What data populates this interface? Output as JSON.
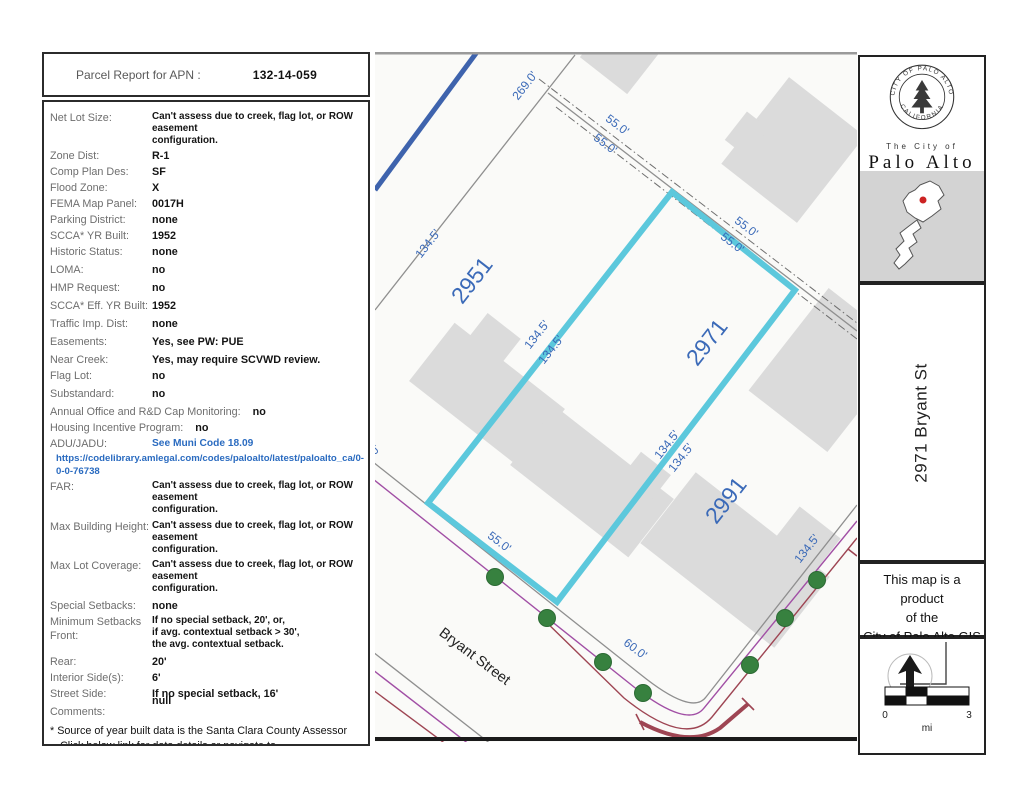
{
  "report": {
    "header_label": "Parcel Report for APN :",
    "apn": "132-14-059",
    "fields": [
      {
        "label": "Net Lot Size:",
        "value": "Can't assess due to creek, flag lot, or ROW easement\nconfiguration.",
        "cls": "ml"
      },
      {
        "label": "Zone Dist:",
        "value": "R-1"
      },
      {
        "label": "Comp Plan Des:",
        "value": "SF"
      },
      {
        "label": "Flood Zone:",
        "value": "X"
      },
      {
        "label": "FEMA Map Panel:",
        "value": "0017H"
      },
      {
        "label": "Parking District:",
        "value": "none"
      },
      {
        "label": "SCCA* YR Built:",
        "value": "1952"
      },
      {
        "label": "Historic Status:",
        "value": "none"
      },
      {
        "label": "LOMA:",
        "value": "no",
        "cls": "gap"
      },
      {
        "label": "HMP Request:",
        "value": "no",
        "cls": "gap"
      },
      {
        "label": "SCCA* Eff. YR Built:",
        "value": "1952",
        "cls": "gap"
      },
      {
        "label": "Traffic Imp. Dist:",
        "value": "none",
        "cls": "gap"
      },
      {
        "label": "Easements:",
        "value": "Yes, see PW: PUE",
        "cls": "gap"
      },
      {
        "label": "Near Creek:",
        "value": "Yes, may require SCVWD review.",
        "cls": "gap"
      },
      {
        "label": "Flag Lot:",
        "value": "no"
      },
      {
        "label": "Substandard:",
        "value": "no",
        "cls": "gap"
      },
      {
        "label": "Annual Office and R&D Cap Monitoring:",
        "value": "no",
        "cls": "wide gap"
      },
      {
        "label": "Housing Incentive Program:",
        "value": "no",
        "cls": "wide"
      },
      {
        "label": "ADU/JADU:",
        "value": "See Muni Code 18.09",
        "cls": "linkval",
        "link": true
      },
      {
        "label": "",
        "value": "https://codelibrary.amlegal.com/codes/paloalto/latest/paloalto_ca/0-0-0-76738",
        "cls": "linkrow",
        "link": true
      },
      {
        "label": "FAR:",
        "value": "Can't assess due to creek, flag lot, or ROW easement\nconfiguration.",
        "cls": "ml"
      },
      {
        "label": "Max Building Height:",
        "value": "Can't assess due to creek, flag lot, or ROW easement\nconfiguration.",
        "cls": "ml gap"
      },
      {
        "label": "Max Lot Coverage:",
        "value": "Can't assess due to creek, flag lot, or ROW easement\nconfiguration.",
        "cls": "ml gap"
      },
      {
        "label": "Special Setbacks:",
        "value": "none",
        "cls": "gap"
      },
      {
        "label": "Minimum Setbacks\nFront:",
        "value": "If no special setback, 20', or,\nif avg. contextual setback > 30',\nthe avg. contextual setback.",
        "cls": "ml"
      },
      {
        "label": "Rear:",
        "value": "20'",
        "cls": "gap"
      },
      {
        "label": "Interior Side(s):",
        "value": "6'"
      },
      {
        "label": "Street Side:",
        "value": "If no special setback, 16'"
      },
      {
        "label": "Comments:",
        "value": "null",
        "cls": "comments gap"
      }
    ],
    "footnote_line1": "* Source of year built data is the Santa Clara County Assessor",
    "footnote_line2": "Click below link for data details or navigate to",
    "footnote_link": "https://www.cityofpaloalto.org/gov/depts/pln/current/parcel_reports.asp"
  },
  "map": {
    "labels": [
      {
        "text": "269.0'"
      },
      {
        "text": "55.0'"
      },
      {
        "text": "55.0'"
      },
      {
        "text": "134.5'"
      },
      {
        "text": "2951"
      },
      {
        "text": "134.5'"
      },
      {
        "text": "134.5'"
      },
      {
        "text": "2971"
      },
      {
        "text": "55.0'"
      },
      {
        "text": "55.0'"
      },
      {
        "text": "134.5'"
      },
      {
        "text": "134.5'"
      },
      {
        "text": "2991"
      },
      {
        "text": "55.0'"
      },
      {
        "text": "60.0'"
      },
      {
        "text": "134.5'"
      },
      {
        "text": "0'"
      },
      {
        "text": "Bryant Street"
      }
    ],
    "colors": {
      "highlight_cyan": "#5cc8dc",
      "creek_blue": "#3e63ad",
      "tree_green": "#37813f",
      "utility_purple": "#a14fa5",
      "water_red": "#9e4553",
      "label_blue": "#3b6ab8",
      "building_gray": "#dbdbdb",
      "link_blue": "#2a6bc0"
    }
  },
  "sidebar": {
    "seal_top": "CITY OF PALO ALTO",
    "seal_bottom": "CALIFORNIA",
    "city_line1": "The City of",
    "city_line2": "Palo Alto",
    "address": "2971 Bryant St",
    "product_line1": "This map is a product",
    "product_line2": "of the",
    "product_line3": "City of Palo Alto GIS",
    "scale": {
      "start": "0",
      "end": "3",
      "unit": "mi"
    }
  }
}
